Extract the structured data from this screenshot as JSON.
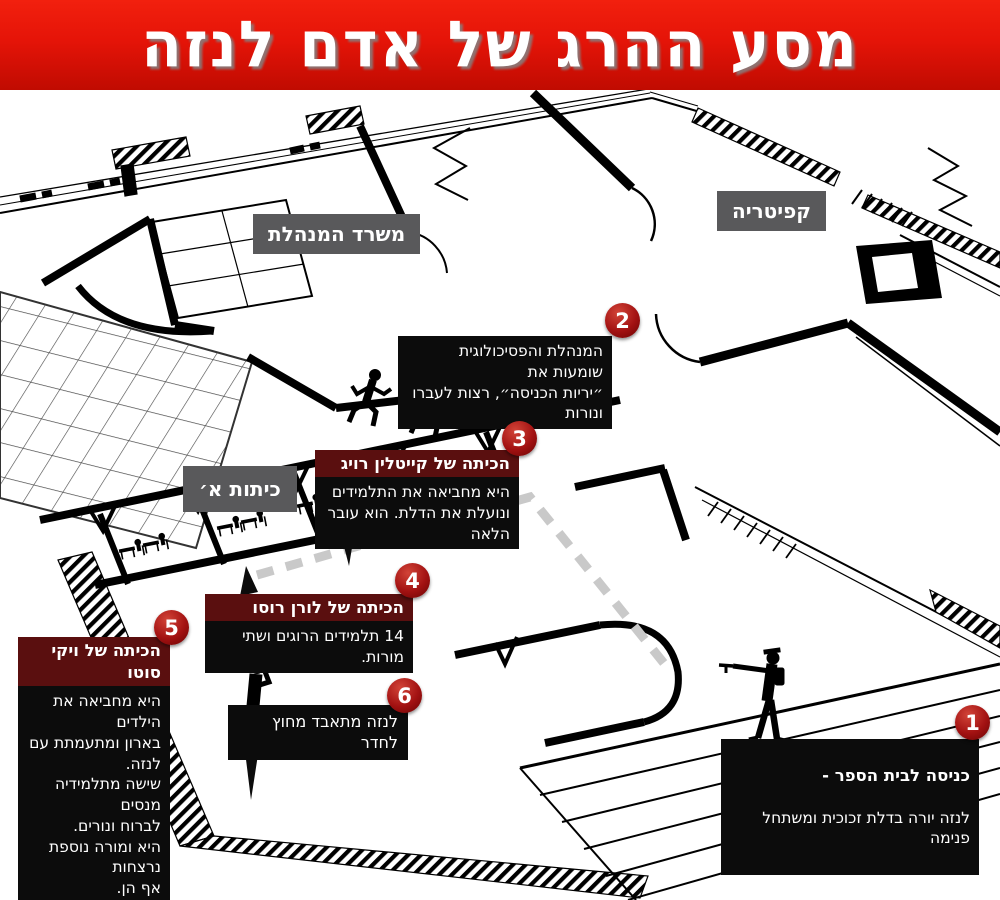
{
  "banner": {
    "title": "מסע ההרג של אדם לנזה"
  },
  "room_labels": {
    "principal_office": "משרד המנהלת",
    "cafeteria": "קפיטריה",
    "first_grade": "כיתות א׳"
  },
  "annotations": {
    "a1": {
      "num": "1",
      "title": "כניסה לבית הספר -",
      "body": "לנזה יורה בדלת זכוכית ומשתחל פנימה"
    },
    "a2": {
      "num": "2",
      "body": "המנהלת והפסיכולוגית שומעות את\n״יריות הכניסה״, רצות לעברו ונורות"
    },
    "a3": {
      "num": "3",
      "title": "הכיתה של קייטלין רויג",
      "body": "היא מחביאה את התלמידים\nונועלת את הדלת. הוא עובר הלאה"
    },
    "a4": {
      "num": "4",
      "title": "הכיתה של לורן רוסו",
      "body": "14 תלמידים הרוגים ושתי מורות."
    },
    "a5": {
      "num": "5",
      "title": "הכיתה של ויקי סוטו",
      "body": "היא מחביאה את הילדים\nבארון ומתעמתת עם לנזה.\nשישה מתלמידיה מנסים\nלברוח ונורים.\nהיא ומורה נוספת נרצחות\nאף הן."
    },
    "a6": {
      "num": "6",
      "body": "לנזה מתאבד מחוץ לחדר"
    }
  },
  "colors": {
    "banner_red": "#e01408",
    "badge_red": "#a31212",
    "header_maroon": "#5a0f0f",
    "box_black": "#0c0c0c",
    "label_gray": "#59595b",
    "route_gray": "#c9c9c9"
  },
  "icons": {
    "shooter": "shooter-icon",
    "suicide": "suicide-icon",
    "runner": "runner-icon",
    "student_desk": "desk-icon"
  }
}
